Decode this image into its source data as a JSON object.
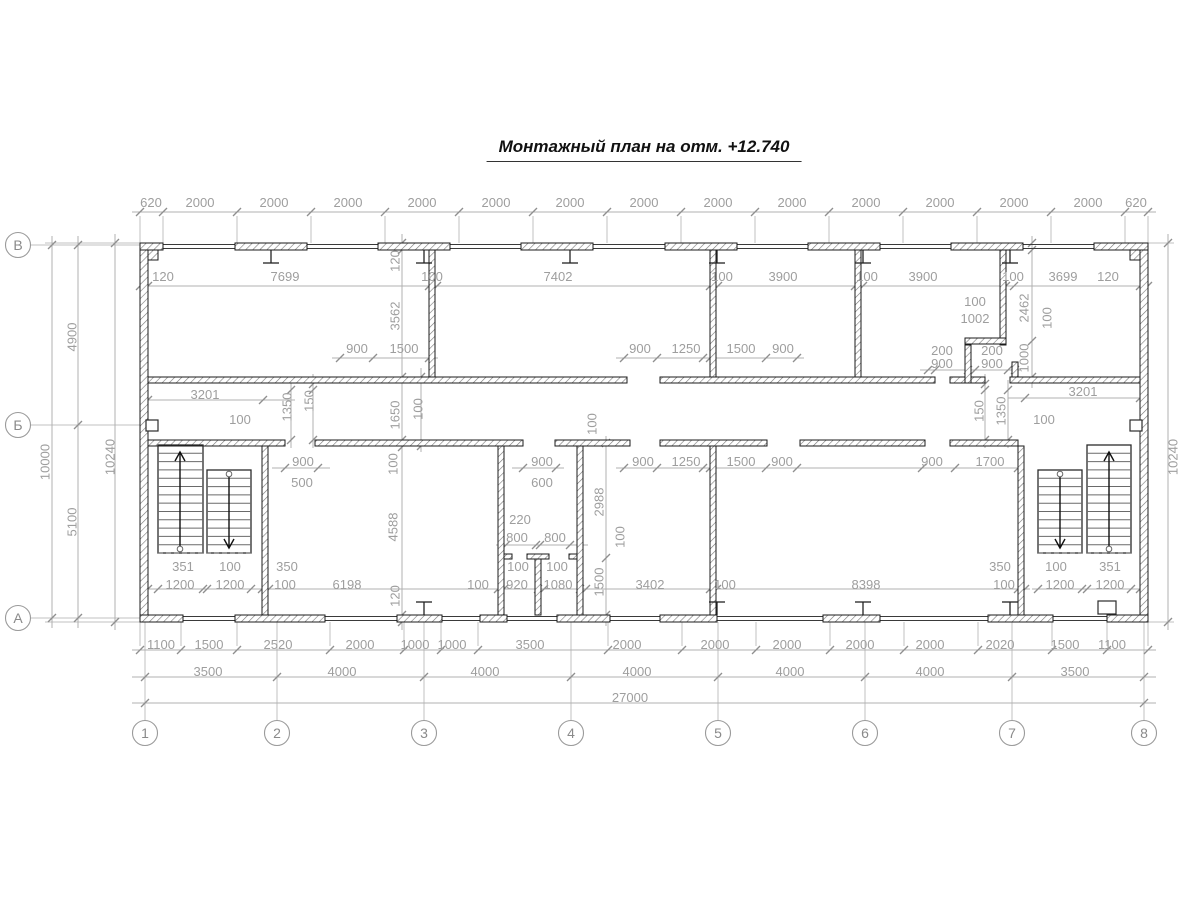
{
  "title": "Монтажный план на отм. +12.740",
  "colors": {
    "wall": "#1b1b1b",
    "dim_text": "#9e9e9e",
    "dim_line": "#b0b0b0"
  },
  "axis_bubbles": {
    "rows": [
      {
        "label": "В",
        "x": 18,
        "y": 245
      },
      {
        "label": "Б",
        "x": 18,
        "y": 425
      },
      {
        "label": "А",
        "x": 18,
        "y": 618
      }
    ],
    "cols": [
      {
        "label": "1",
        "x": 145,
        "y": 733
      },
      {
        "label": "2",
        "x": 277,
        "y": 733
      },
      {
        "label": "3",
        "x": 424,
        "y": 733
      },
      {
        "label": "4",
        "x": 571,
        "y": 733
      },
      {
        "label": "5",
        "x": 718,
        "y": 733
      },
      {
        "label": "6",
        "x": 865,
        "y": 733
      },
      {
        "label": "7",
        "x": 1012,
        "y": 733
      },
      {
        "label": "8",
        "x": 1144,
        "y": 733
      }
    ]
  },
  "labels": [
    {
      "t": "620",
      "x": 151,
      "y": 207
    },
    {
      "t": "2000",
      "x": 200,
      "y": 207
    },
    {
      "t": "2000",
      "x": 274,
      "y": 207
    },
    {
      "t": "2000",
      "x": 348,
      "y": 207
    },
    {
      "t": "2000",
      "x": 422,
      "y": 207
    },
    {
      "t": "2000",
      "x": 496,
      "y": 207
    },
    {
      "t": "2000",
      "x": 570,
      "y": 207
    },
    {
      "t": "2000",
      "x": 644,
      "y": 207
    },
    {
      "t": "2000",
      "x": 718,
      "y": 207
    },
    {
      "t": "2000",
      "x": 792,
      "y": 207
    },
    {
      "t": "2000",
      "x": 866,
      "y": 207
    },
    {
      "t": "2000",
      "x": 940,
      "y": 207
    },
    {
      "t": "2000",
      "x": 1014,
      "y": 207
    },
    {
      "t": "2000",
      "x": 1088,
      "y": 207
    },
    {
      "t": "620",
      "x": 1136,
      "y": 207
    },
    {
      "t": "120",
      "x": 163,
      "y": 281
    },
    {
      "t": "7699",
      "x": 285,
      "y": 281
    },
    {
      "t": "100",
      "x": 432,
      "y": 281
    },
    {
      "t": "7402",
      "x": 558,
      "y": 281
    },
    {
      "t": "100",
      "x": 722,
      "y": 281
    },
    {
      "t": "3900",
      "x": 783,
      "y": 281
    },
    {
      "t": "100",
      "x": 867,
      "y": 281
    },
    {
      "t": "3900",
      "x": 923,
      "y": 281
    },
    {
      "t": "100",
      "x": 1013,
      "y": 281
    },
    {
      "t": "3699",
      "x": 1063,
      "y": 281
    },
    {
      "t": "120",
      "x": 1108,
      "y": 281
    },
    {
      "t": "900",
      "x": 357,
      "y": 353
    },
    {
      "t": "1500",
      "x": 404,
      "y": 353
    },
    {
      "t": "900",
      "x": 640,
      "y": 353
    },
    {
      "t": "1250",
      "x": 686,
      "y": 353
    },
    {
      "t": "1500",
      "x": 741,
      "y": 353
    },
    {
      "t": "900",
      "x": 783,
      "y": 353
    },
    {
      "t": "200",
      "x": 942,
      "y": 355
    },
    {
      "t": "900",
      "x": 942,
      "y": 368
    },
    {
      "t": "200",
      "x": 992,
      "y": 355
    },
    {
      "t": "900",
      "x": 992,
      "y": 368
    },
    {
      "t": "100",
      "x": 975,
      "y": 306
    },
    {
      "t": "1002",
      "x": 975,
      "y": 323
    },
    {
      "t": "3201",
      "x": 205,
      "y": 399
    },
    {
      "t": "3201",
      "x": 1083,
      "y": 396
    },
    {
      "t": "100",
      "x": 240,
      "y": 424
    },
    {
      "t": "100",
      "x": 1044,
      "y": 424
    },
    {
      "t": "900",
      "x": 303,
      "y": 466
    },
    {
      "t": "900",
      "x": 542,
      "y": 466
    },
    {
      "t": "900",
      "x": 643,
      "y": 466
    },
    {
      "t": "1250",
      "x": 686,
      "y": 466
    },
    {
      "t": "1500",
      "x": 741,
      "y": 466
    },
    {
      "t": "900",
      "x": 782,
      "y": 466
    },
    {
      "t": "900",
      "x": 932,
      "y": 466
    },
    {
      "t": "1700",
      "x": 990,
      "y": 466
    },
    {
      "t": "500",
      "x": 302,
      "y": 487
    },
    {
      "t": "600",
      "x": 542,
      "y": 487
    },
    {
      "t": "220",
      "x": 520,
      "y": 524
    },
    {
      "t": "800",
      "x": 517,
      "y": 542
    },
    {
      "t": "800",
      "x": 555,
      "y": 542
    },
    {
      "t": "351",
      "x": 183,
      "y": 571
    },
    {
      "t": "100",
      "x": 230,
      "y": 571
    },
    {
      "t": "350",
      "x": 287,
      "y": 571
    },
    {
      "t": "100",
      "x": 518,
      "y": 571
    },
    {
      "t": "100",
      "x": 557,
      "y": 571
    },
    {
      "t": "350",
      "x": 1000,
      "y": 571
    },
    {
      "t": "100",
      "x": 1056,
      "y": 571
    },
    {
      "t": "351",
      "x": 1110,
      "y": 571
    },
    {
      "t": "1200",
      "x": 180,
      "y": 589
    },
    {
      "t": "1200",
      "x": 230,
      "y": 589
    },
    {
      "t": "100",
      "x": 285,
      "y": 589
    },
    {
      "t": "6198",
      "x": 347,
      "y": 589
    },
    {
      "t": "100",
      "x": 478,
      "y": 589
    },
    {
      "t": "920",
      "x": 517,
      "y": 589
    },
    {
      "t": "1080",
      "x": 558,
      "y": 589
    },
    {
      "t": "3402",
      "x": 650,
      "y": 589
    },
    {
      "t": "100",
      "x": 725,
      "y": 589
    },
    {
      "t": "8398",
      "x": 866,
      "y": 589
    },
    {
      "t": "100",
      "x": 1004,
      "y": 589
    },
    {
      "t": "1200",
      "x": 1060,
      "y": 589
    },
    {
      "t": "1200",
      "x": 1110,
      "y": 589
    },
    {
      "t": "1100",
      "x": 161,
      "y": 649
    },
    {
      "t": "1500",
      "x": 209,
      "y": 649
    },
    {
      "t": "2520",
      "x": 278,
      "y": 649
    },
    {
      "t": "2000",
      "x": 360,
      "y": 649
    },
    {
      "t": "1000",
      "x": 415,
      "y": 649
    },
    {
      "t": "1000",
      "x": 452,
      "y": 649
    },
    {
      "t": "3500",
      "x": 530,
      "y": 649
    },
    {
      "t": "2000",
      "x": 627,
      "y": 649
    },
    {
      "t": "2000",
      "x": 715,
      "y": 649
    },
    {
      "t": "2000",
      "x": 787,
      "y": 649
    },
    {
      "t": "2000",
      "x": 860,
      "y": 649
    },
    {
      "t": "2000",
      "x": 930,
      "y": 649
    },
    {
      "t": "2020",
      "x": 1000,
      "y": 649
    },
    {
      "t": "1500",
      "x": 1065,
      "y": 649
    },
    {
      "t": "1100",
      "x": 1112,
      "y": 649
    },
    {
      "t": "3500",
      "x": 208,
      "y": 676
    },
    {
      "t": "4000",
      "x": 342,
      "y": 676
    },
    {
      "t": "4000",
      "x": 485,
      "y": 676
    },
    {
      "t": "4000",
      "x": 637,
      "y": 676
    },
    {
      "t": "4000",
      "x": 790,
      "y": 676
    },
    {
      "t": "4000",
      "x": 930,
      "y": 676
    },
    {
      "t": "3500",
      "x": 1075,
      "y": 676
    },
    {
      "t": "27000",
      "x": 630,
      "y": 702
    },
    {
      "t": "120",
      "x": 395,
      "y": 261,
      "v": 1
    },
    {
      "t": "3562",
      "x": 395,
      "y": 316,
      "v": 1
    },
    {
      "t": "1650",
      "x": 395,
      "y": 415,
      "v": 1
    },
    {
      "t": "100",
      "x": 418,
      "y": 409,
      "v": 1
    },
    {
      "t": "100",
      "x": 393,
      "y": 464,
      "v": 1
    },
    {
      "t": "4588",
      "x": 393,
      "y": 527,
      "v": 1
    },
    {
      "t": "120",
      "x": 395,
      "y": 596,
      "v": 1
    },
    {
      "t": "2988",
      "x": 599,
      "y": 502,
      "v": 1
    },
    {
      "t": "1500",
      "x": 599,
      "y": 582,
      "v": 1
    },
    {
      "t": "100",
      "x": 592,
      "y": 424,
      "v": 1
    },
    {
      "t": "100",
      "x": 620,
      "y": 537,
      "v": 1
    },
    {
      "t": "2462",
      "x": 1024,
      "y": 308,
      "v": 1
    },
    {
      "t": "100",
      "x": 1047,
      "y": 318,
      "v": 1
    },
    {
      "t": "1000",
      "x": 1024,
      "y": 358,
      "v": 1
    },
    {
      "t": "150",
      "x": 979,
      "y": 411,
      "v": 1
    },
    {
      "t": "1350",
      "x": 1001,
      "y": 411,
      "v": 1
    },
    {
      "t": "1350",
      "x": 287,
      "y": 407,
      "v": 1
    },
    {
      "t": "150",
      "x": 309,
      "y": 401,
      "v": 1
    },
    {
      "t": "4900",
      "x": 72,
      "y": 337,
      "v": 1
    },
    {
      "t": "10000",
      "x": 45,
      "y": 462,
      "v": 1
    },
    {
      "t": "5100",
      "x": 72,
      "y": 522,
      "v": 1
    },
    {
      "t": "10240",
      "x": 110,
      "y": 457,
      "v": 1
    },
    {
      "t": "10240",
      "x": 1173,
      "y": 457,
      "v": 1
    }
  ]
}
